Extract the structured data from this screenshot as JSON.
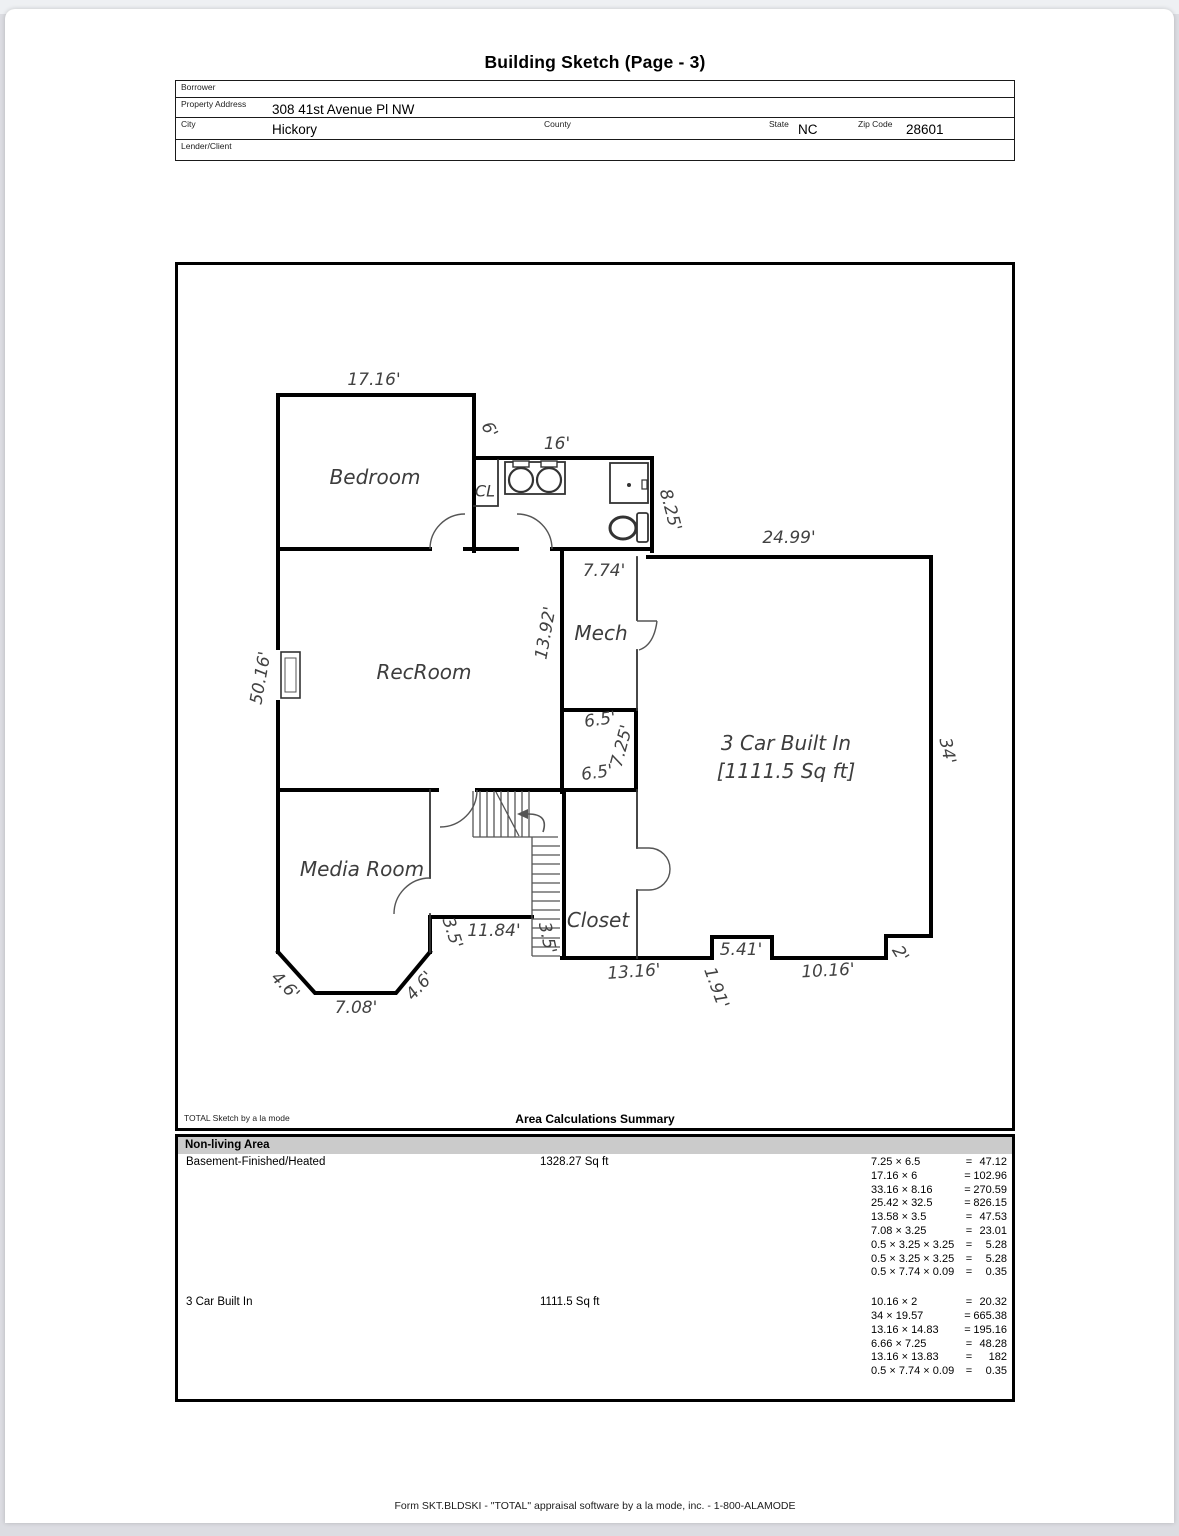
{
  "title": "Building Sketch (Page - 3)",
  "header": {
    "borrower_label": "Borrower",
    "borrower": "",
    "property_address_label": "Property Address",
    "property_address": "308 41st Avenue Pl NW",
    "city_label": "City",
    "city": "Hickory",
    "county_label": "County",
    "county": "",
    "state_label": "State",
    "state": "NC",
    "zip_label": "Zip Code",
    "zip": "28601",
    "lender_label": "Lender/Client",
    "lender": ""
  },
  "sketch": {
    "credit": "TOTAL Sketch by a la mode",
    "labels": [
      {
        "t": "Bedroom",
        "x": 375,
        "y": 477,
        "r": 0,
        "k": "room"
      },
      {
        "t": "CL",
        "x": 485,
        "y": 491,
        "r": 0,
        "k": "room-sm"
      },
      {
        "t": "RecRoom",
        "x": 424,
        "y": 672,
        "r": 0,
        "k": "room"
      },
      {
        "t": "Mech",
        "x": 601,
        "y": 633,
        "r": 0,
        "k": "room"
      },
      {
        "t": "Media Room",
        "x": 362,
        "y": 869,
        "r": 0,
        "k": "room"
      },
      {
        "t": "Closet",
        "x": 598,
        "y": 920,
        "r": 0,
        "k": "room"
      },
      {
        "t": "3 Car Built In",
        "x": 786,
        "y": 743,
        "r": 0,
        "k": "room"
      },
      {
        "t": "[1111.5 Sq ft]",
        "x": 786,
        "y": 771,
        "r": 0,
        "k": "room"
      },
      {
        "t": "17.16'",
        "x": 374,
        "y": 380,
        "r": 0,
        "k": "dim"
      },
      {
        "t": "6'",
        "x": 489,
        "y": 430,
        "r": 62,
        "k": "dim"
      },
      {
        "t": "16'",
        "x": 557,
        "y": 444,
        "r": 0,
        "k": "dim"
      },
      {
        "t": "8.25'",
        "x": 670,
        "y": 510,
        "r": 75,
        "k": "dim"
      },
      {
        "t": "24.99'",
        "x": 789,
        "y": 538,
        "r": 0,
        "k": "dim"
      },
      {
        "t": "7.74'",
        "x": 604,
        "y": 571,
        "r": 0,
        "k": "dim"
      },
      {
        "t": "13.92'",
        "x": 546,
        "y": 633,
        "r": -80,
        "k": "dim"
      },
      {
        "t": "50.16'",
        "x": 261,
        "y": 678,
        "r": -80,
        "k": "dim"
      },
      {
        "t": "6.5'",
        "x": 600,
        "y": 720,
        "r": -8,
        "k": "dim"
      },
      {
        "t": "7.25'",
        "x": 622,
        "y": 746,
        "r": -75,
        "k": "dim"
      },
      {
        "t": "6.5'",
        "x": 597,
        "y": 773,
        "r": -8,
        "k": "dim"
      },
      {
        "t": "34'",
        "x": 947,
        "y": 751,
        "r": 78,
        "k": "dim"
      },
      {
        "t": "3.5'",
        "x": 452,
        "y": 933,
        "r": 72,
        "k": "dim"
      },
      {
        "t": "11.84'",
        "x": 494,
        "y": 931,
        "r": 0,
        "k": "dim"
      },
      {
        "t": "3.5'",
        "x": 547,
        "y": 938,
        "r": 78,
        "k": "dim"
      },
      {
        "t": "13.16'",
        "x": 634,
        "y": 972,
        "r": -4,
        "k": "dim"
      },
      {
        "t": "5.41'",
        "x": 741,
        "y": 950,
        "r": 0,
        "k": "dim"
      },
      {
        "t": "1.91'",
        "x": 716,
        "y": 988,
        "r": 70,
        "k": "dim"
      },
      {
        "t": "10.16'",
        "x": 828,
        "y": 971,
        "r": -3,
        "k": "dim"
      },
      {
        "t": "2'",
        "x": 900,
        "y": 954,
        "r": 58,
        "k": "dim"
      },
      {
        "t": "4.6'",
        "x": 285,
        "y": 986,
        "r": 45,
        "k": "dim"
      },
      {
        "t": "7.08'",
        "x": 356,
        "y": 1008,
        "r": 0,
        "k": "dim"
      },
      {
        "t": "4.6'",
        "x": 420,
        "y": 986,
        "r": -48,
        "k": "dim"
      }
    ]
  },
  "summary": {
    "title": "Area Calculations Summary",
    "section": "Non-living Area",
    "rows": [
      {
        "name": "Basement-Finished/Heated",
        "area": "1328.27 Sq ft",
        "calcs": [
          {
            "expr": "7.25 × 6.5",
            "result": "47.12"
          },
          {
            "expr": "17.16 × 6",
            "result": "102.96"
          },
          {
            "expr": "33.16 × 8.16",
            "result": "270.59"
          },
          {
            "expr": "25.42 × 32.5",
            "result": "826.15"
          },
          {
            "expr": "13.58 × 3.5",
            "result": "47.53"
          },
          {
            "expr": "7.08 × 3.25",
            "result": "23.01"
          },
          {
            "expr": "0.5 × 3.25 × 3.25",
            "result": "5.28"
          },
          {
            "expr": "0.5 × 3.25 × 3.25",
            "result": "5.28"
          },
          {
            "expr": "0.5 × 7.74 × 0.09",
            "result": "0.35"
          }
        ]
      },
      {
        "name": "3 Car Built In",
        "area": "1111.5 Sq ft",
        "calcs": [
          {
            "expr": "10.16 × 2",
            "result": "20.32"
          },
          {
            "expr": "34 × 19.57",
            "result": "665.38"
          },
          {
            "expr": "13.16 × 14.83",
            "result": "195.16"
          },
          {
            "expr": "6.66 × 7.25",
            "result": "48.28"
          },
          {
            "expr": "13.16 × 13.83",
            "result": "182"
          },
          {
            "expr": "0.5 × 7.74 × 0.09",
            "result": "0.35"
          }
        ]
      }
    ]
  },
  "footer": "Form SKT.BLDSKI - \"TOTAL\" appraisal software by a la mode, inc. - 1-800-ALAMODE"
}
